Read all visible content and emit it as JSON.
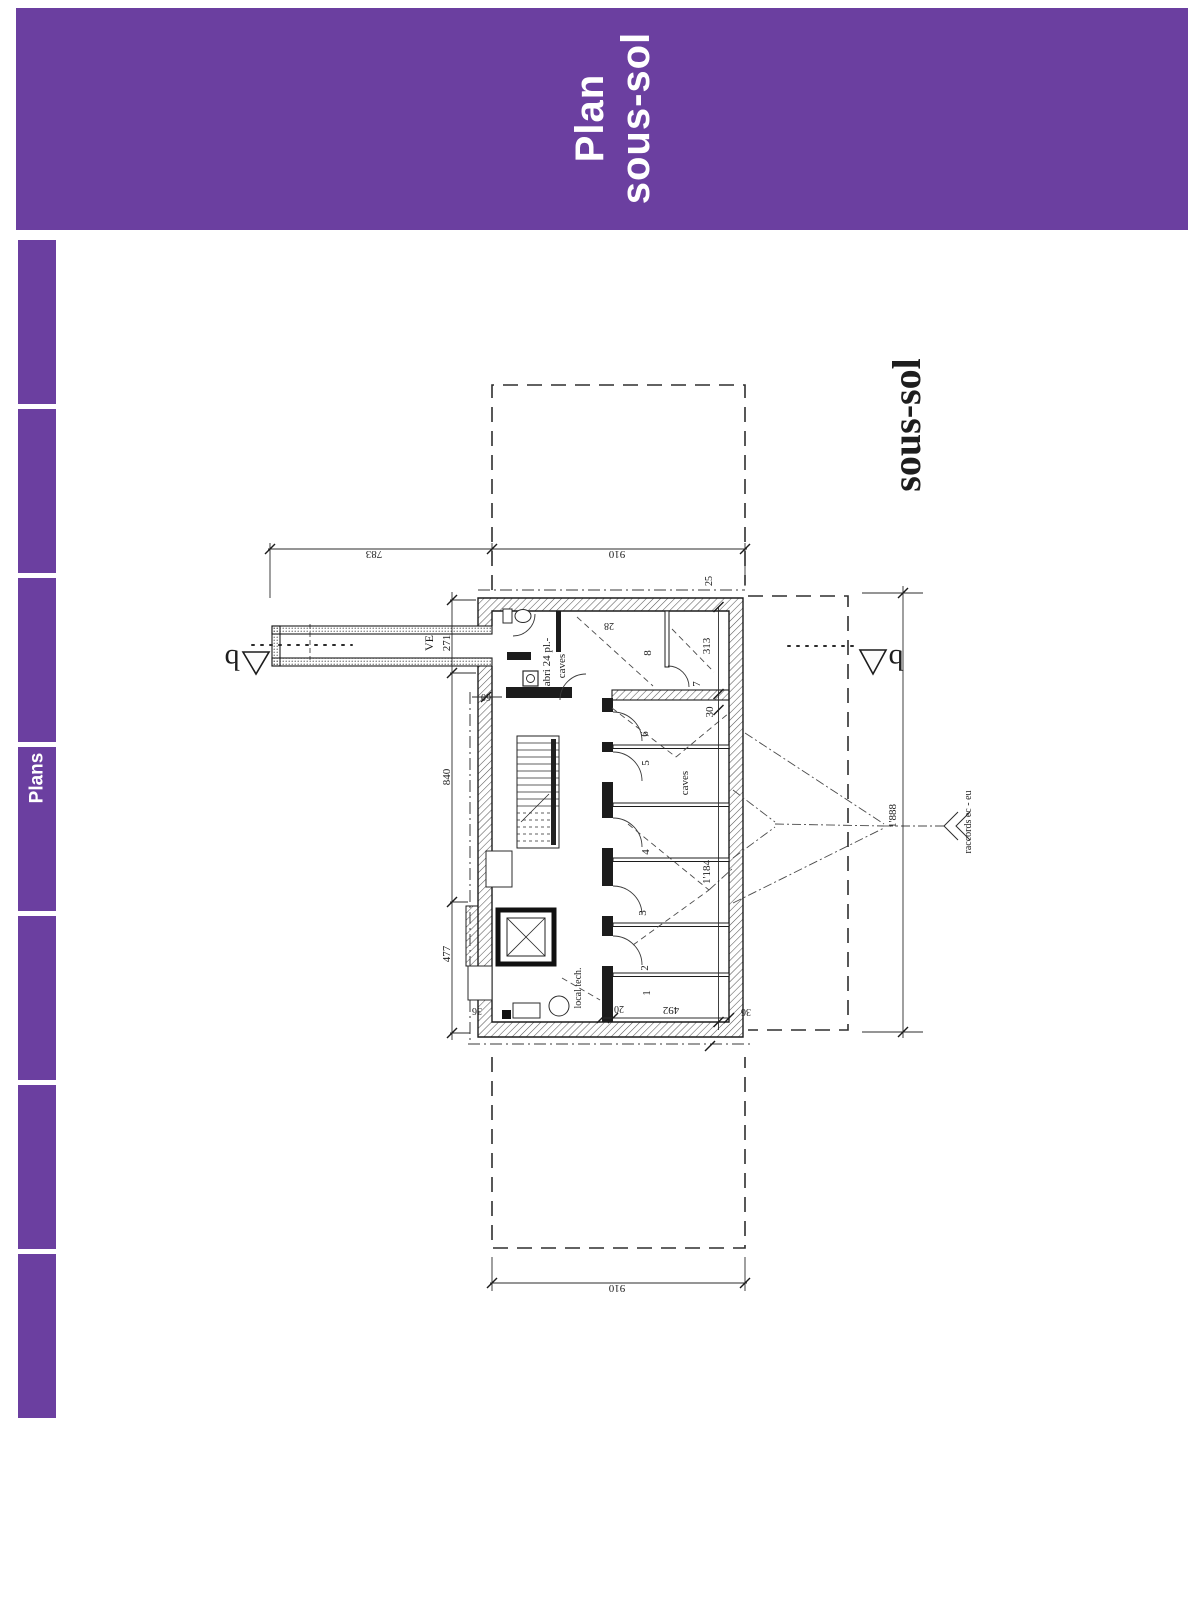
{
  "colors": {
    "accent_purple": "#6b3fa0",
    "line": "#2b2b2b",
    "paper": "#ffffff"
  },
  "header": {
    "title_line1": "Plan",
    "title_line2": "sous-sol"
  },
  "sidebar": {
    "active_tab_label": "Plans",
    "tab_count": 7
  },
  "drawing": {
    "labels": {
      "title": "sous-sol",
      "ve": "VE",
      "abri_line1": "abri 24 pl.-",
      "abri_line2": "caves",
      "caves": "caves",
      "local_tech": "local tech.",
      "raccords": "raccords ec - eu",
      "section": "b",
      "room_1": "1",
      "room_2": "2",
      "room_3": "3",
      "room_4": "4",
      "room_5": "5",
      "room_6": "6",
      "room_7": "7",
      "room_8": "8",
      "dim_783": "783",
      "dim_910_top": "910",
      "dim_910_bottom": "910",
      "dim_271": "271",
      "dim_840": "840",
      "dim_477": "477",
      "dim_1888": "1'888",
      "dim_313": "313",
      "dim_30": "30",
      "dim_1184": "1'184",
      "dim_492": "492",
      "dim_20": "20",
      "dim_25": "25",
      "dim_28": "28",
      "dim_36_left": "36",
      "dim_36_right": "36",
      "dim_60": "60"
    }
  }
}
